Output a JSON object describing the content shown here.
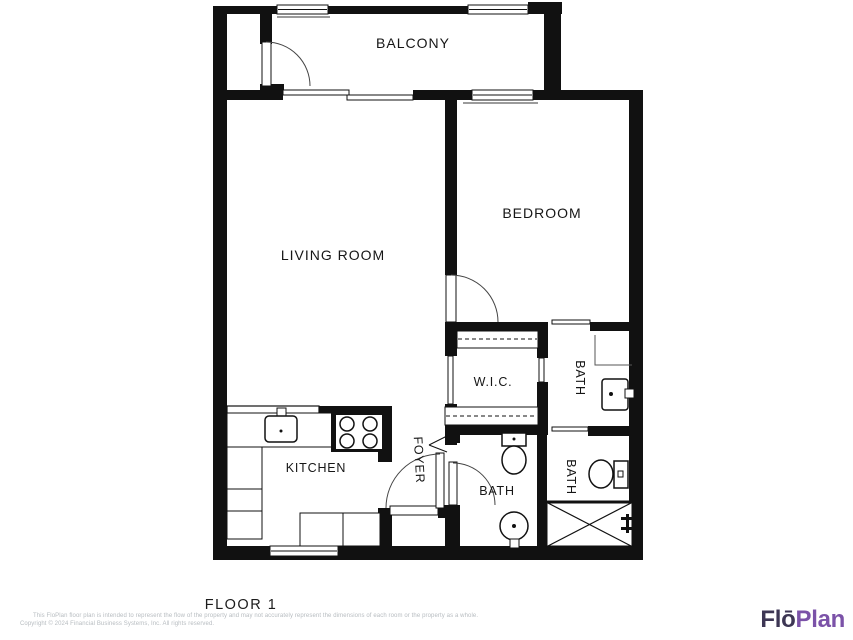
{
  "floor": {
    "title": "FLOOR 1"
  },
  "rooms": {
    "balcony": "BALCONY",
    "living_room": "LIVING ROOM",
    "bedroom": "BEDROOM",
    "wic": "W.I.C.",
    "bath_ensuite": "BATH",
    "bath_middle": "BATH",
    "bath_lower_right": "BATH",
    "kitchen": "KITCHEN",
    "foyer": "FOYER"
  },
  "footer": {
    "disclaimer_line1": "This FloPlan floor plan is intended to represent the flow of the property and may not accurately represent the dimensions of each room or the property as a whole.",
    "disclaimer_line2": "Copyright © 2024 Financial Business Systems, Inc. All rights reserved."
  },
  "logo": {
    "part1": "Flō",
    "part2": "Plan",
    "part1_color": "#3d3654",
    "part2_color": "#7b52a8"
  },
  "plan": {
    "wall_color": "#111111",
    "background": "#ffffff"
  }
}
